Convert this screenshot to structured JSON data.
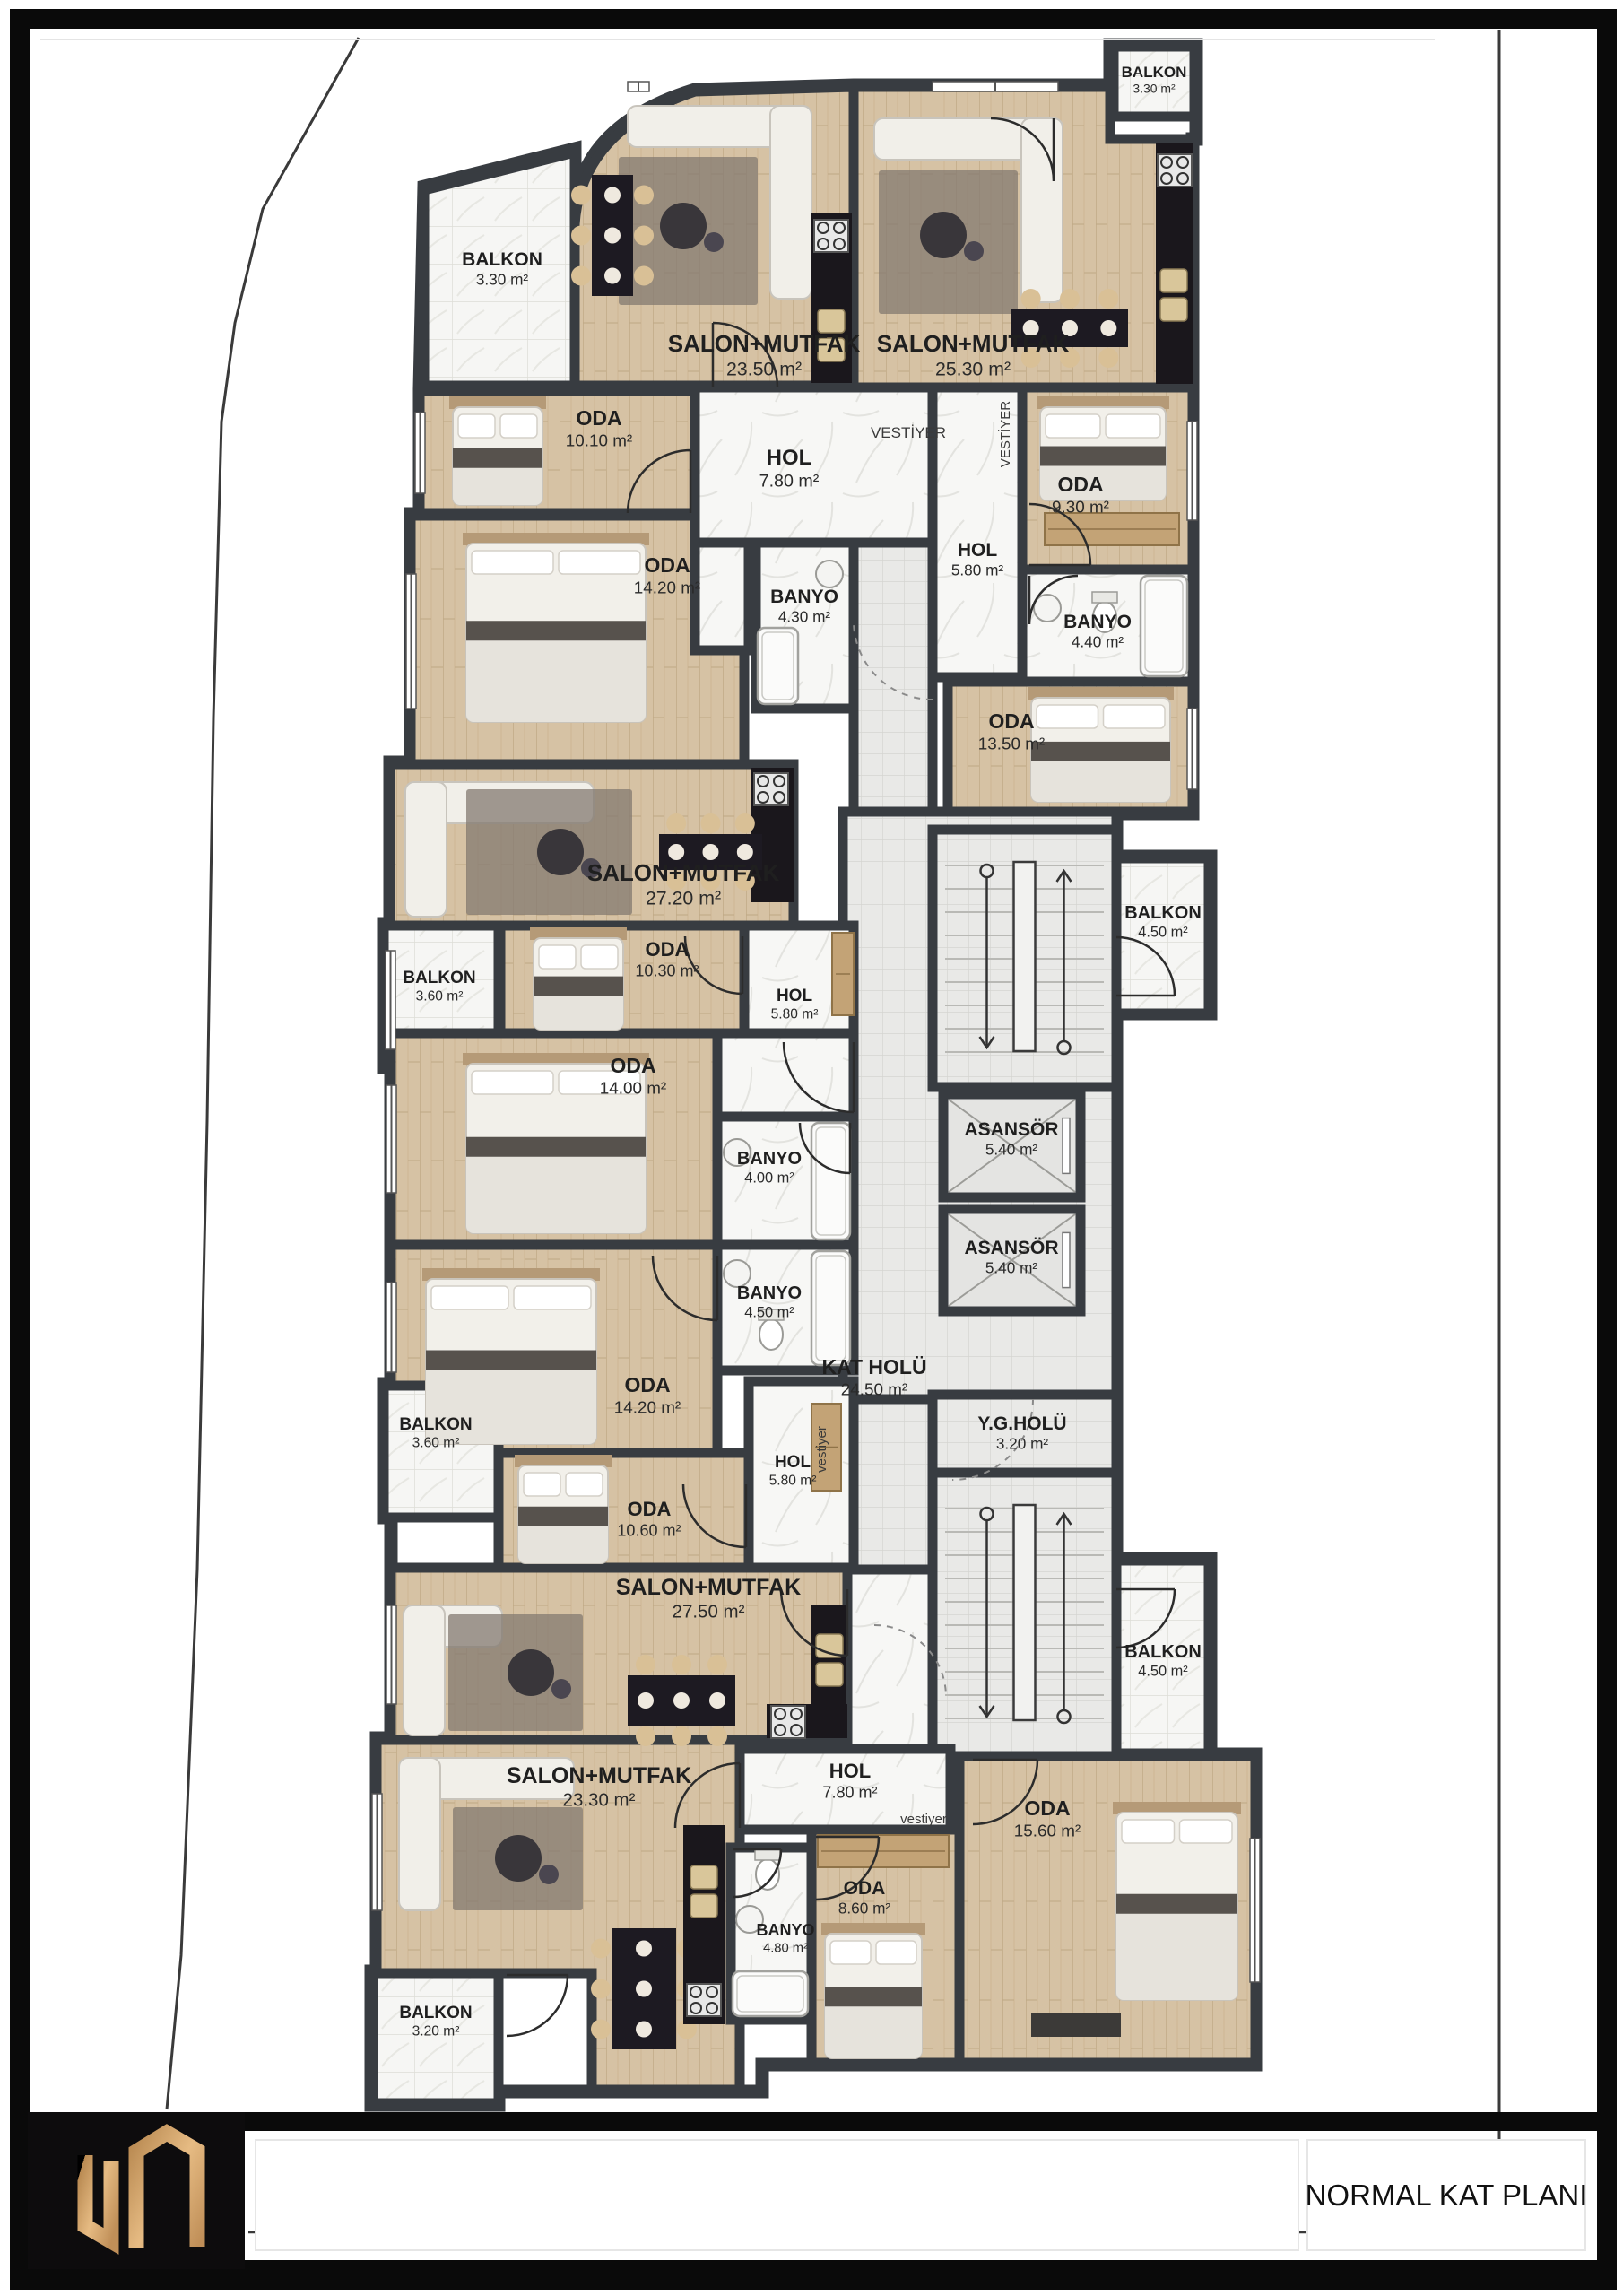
{
  "title_block": {
    "plan_title": "NORMAL KAT PLANI",
    "logo_monogram": "UM"
  },
  "rooms": [
    {
      "id": "balkon-ust-sol",
      "label": "BALKON",
      "area": "3.30 m²"
    },
    {
      "id": "salon-mutfak-2350",
      "label": "SALON+MUTFAK",
      "area": "23.50 m²"
    },
    {
      "id": "salon-mutfak-2530",
      "label": "SALON+MUTFAK",
      "area": "25.30 m²"
    },
    {
      "id": "balkon-ust-sag",
      "label": "BALKON",
      "area": "3.30 m²"
    },
    {
      "id": "oda-1010",
      "label": "ODA",
      "area": "10.10 m²"
    },
    {
      "id": "hol-780-ust",
      "label": "HOL",
      "area": "7.80 m²"
    },
    {
      "id": "oda-930",
      "label": "ODA",
      "area": "9.30 m²"
    },
    {
      "id": "hol-580-sag",
      "label": "HOL",
      "area": "5.80 m²"
    },
    {
      "id": "banyo-430",
      "label": "BANYO",
      "area": "4.30 m²"
    },
    {
      "id": "oda-1420-ust",
      "label": "ODA",
      "area": "14.20 m²"
    },
    {
      "id": "banyo-440",
      "label": "BANYO",
      "area": "4.40 m²"
    },
    {
      "id": "oda-1350",
      "label": "ODA",
      "area": "13.50 m²"
    },
    {
      "id": "salon-mutfak-2720",
      "label": "SALON+MUTFAK",
      "area": "27.20 m²"
    },
    {
      "id": "balkon-360-ust",
      "label": "BALKON",
      "area": "3.60 m²"
    },
    {
      "id": "oda-1030",
      "label": "ODA",
      "area": "10.30 m²"
    },
    {
      "id": "hol-580-orta",
      "label": "HOL",
      "area": "5.80 m²"
    },
    {
      "id": "oda-1400",
      "label": "ODA",
      "area": "14.00 m²"
    },
    {
      "id": "banyo-400",
      "label": "BANYO",
      "area": "4.00 m²"
    },
    {
      "id": "banyo-450",
      "label": "BANYO",
      "area": "4.50 m²"
    },
    {
      "id": "oda-1420-alt",
      "label": "ODA",
      "area": "14.20 m²"
    },
    {
      "id": "kat-holu",
      "label": "KAT HOLÜ",
      "area": "24.50 m²"
    },
    {
      "id": "asansor-1",
      "label": "ASANSÖR",
      "area": "5.40 m²"
    },
    {
      "id": "asansor-2",
      "label": "ASANSÖR",
      "area": "5.40 m²"
    },
    {
      "id": "balkon-450-ust",
      "label": "BALKON",
      "area": "4.50 m²"
    },
    {
      "id": "yg-holu",
      "label": "Y.G.HOLÜ",
      "area": "3.20 m²"
    },
    {
      "id": "balkon-450-alt",
      "label": "BALKON",
      "area": "4.50 m²"
    },
    {
      "id": "balkon-360-alt",
      "label": "BALKON",
      "area": "3.60 m²"
    },
    {
      "id": "oda-1060",
      "label": "ODA",
      "area": "10.60 m²"
    },
    {
      "id": "hol-580-alt",
      "label": "HOL",
      "area": "5.80 m²"
    },
    {
      "id": "salon-mutfak-2750",
      "label": "SALON+MUTFAK",
      "area": "27.50 m²"
    },
    {
      "id": "salon-mutfak-2330",
      "label": "SALON+MUTFAK",
      "area": "23.30 m²"
    },
    {
      "id": "balkon-320",
      "label": "BALKON",
      "area": "3.20 m²"
    },
    {
      "id": "banyo-480",
      "label": "BANYO",
      "area": "4.80 m²"
    },
    {
      "id": "oda-860",
      "label": "ODA",
      "area": "8.60 m²"
    },
    {
      "id": "hol-780-alt",
      "label": "HOL",
      "area": "7.80 m²"
    },
    {
      "id": "oda-1560",
      "label": "ODA",
      "area": "15.60 m²"
    }
  ],
  "wardrobe_labels": [
    {
      "id": "vestiyer-ust",
      "text": "VESTİYER"
    },
    {
      "id": "vestiyer-ust-sag",
      "text": "VESTİYER"
    },
    {
      "id": "vestiyer-orta",
      "text": "vestiyer"
    },
    {
      "id": "vestiyer-alt",
      "text": "vestiyer"
    }
  ],
  "colors": {
    "wall": "#383c41",
    "wood": "#d6c2a4",
    "marble": "#f7f7f5",
    "tile": "#e9e9e7",
    "counter": "#1a171c",
    "logo_gold": "#c79a62",
    "frame": "#0a0a0a",
    "label": "#1f1f1f"
  }
}
